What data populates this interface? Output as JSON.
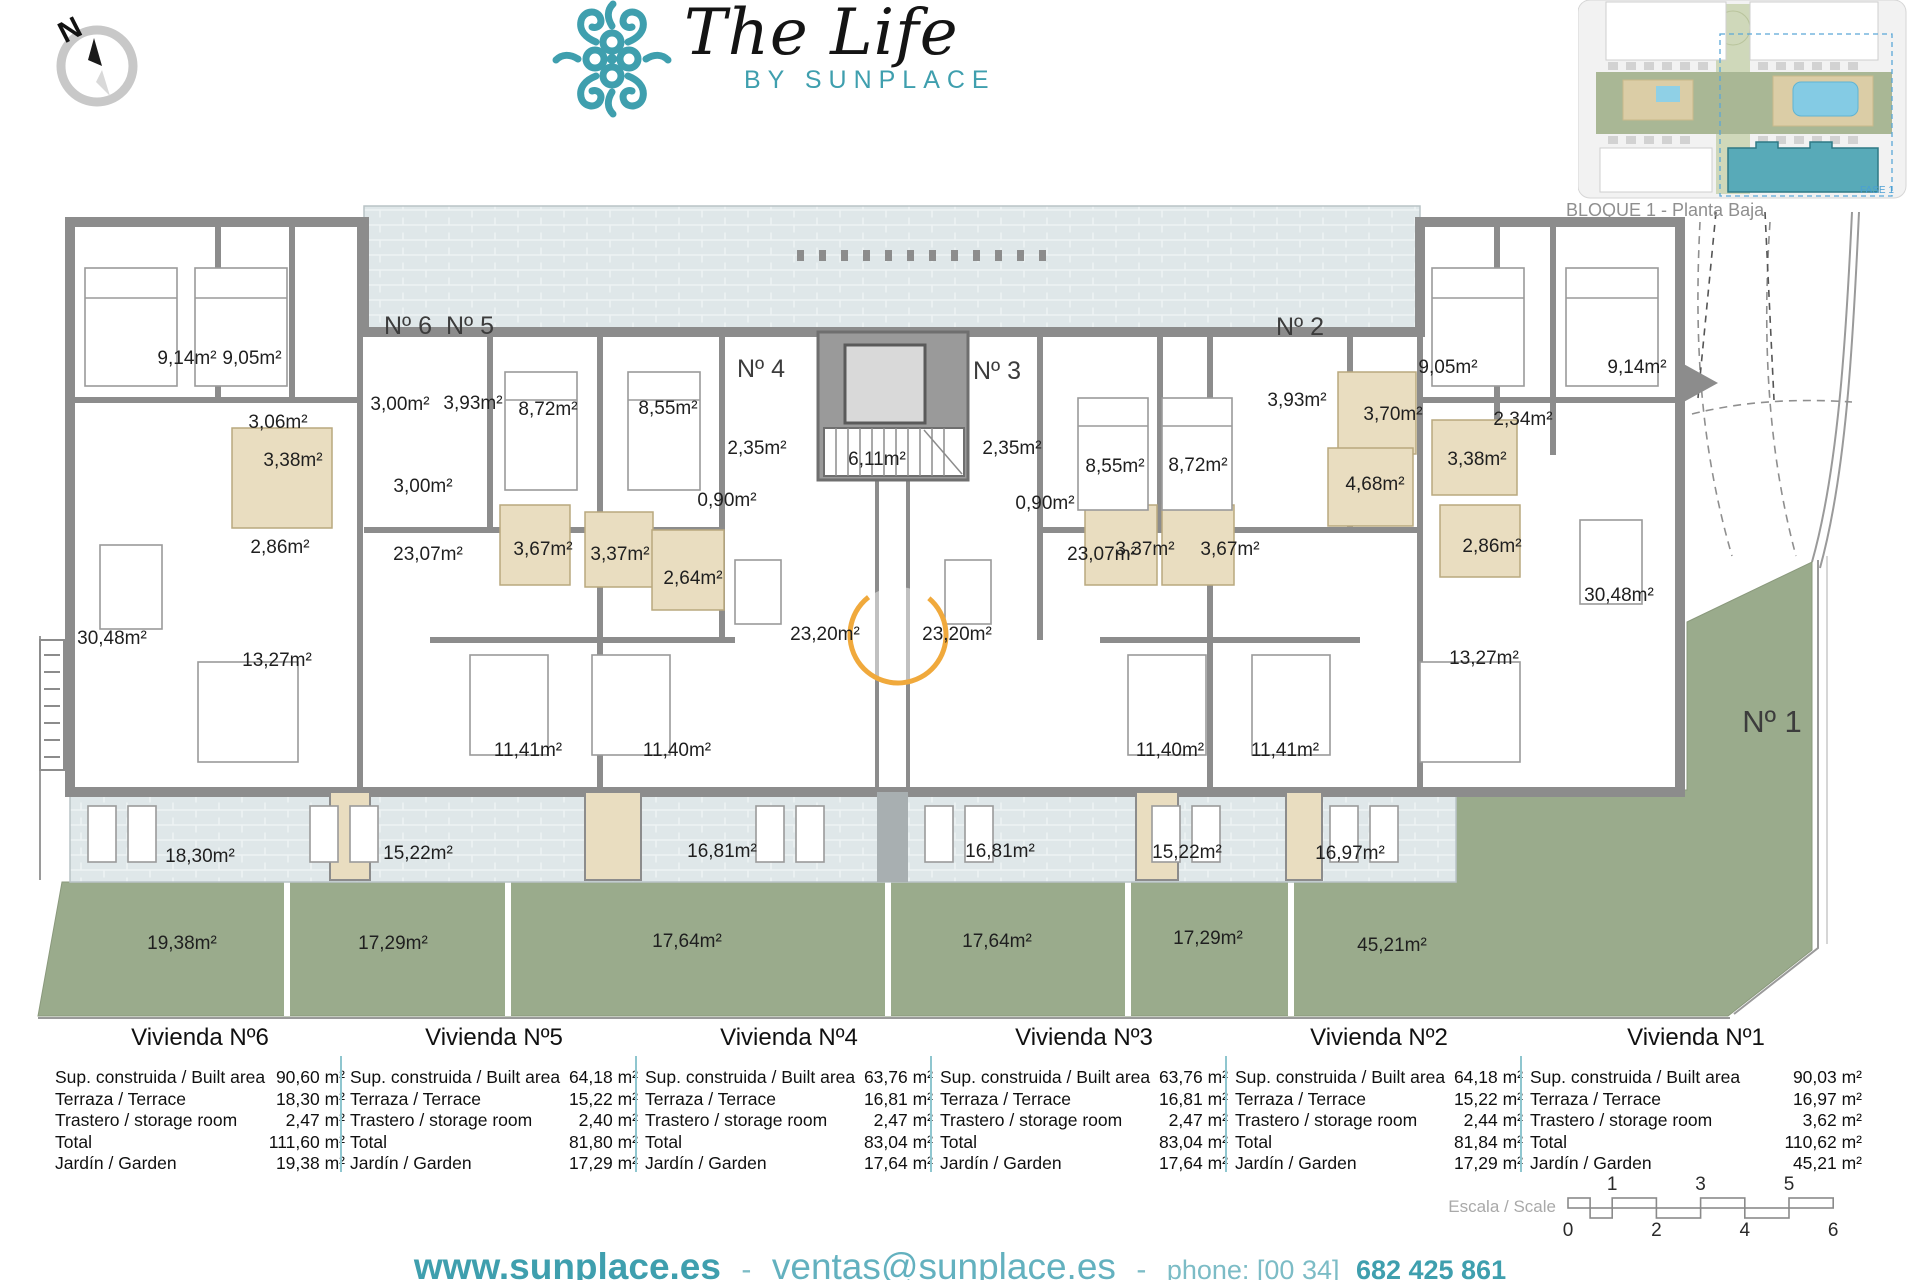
{
  "brand": {
    "title": "The Life",
    "subtitle": "BY SUNPLACE",
    "accent_color": "#3f9fae"
  },
  "compass": {
    "label": "N"
  },
  "site_inset": {
    "caption": "BLOQUE 1 - Planta Baja",
    "fase_label": "FASE 1",
    "highlight_color": "#58aab8",
    "pool_color": "#84cbe4",
    "green_color": "#a9b795"
  },
  "plan": {
    "wall_color": "#8c8c8c",
    "terrace_color": "#dfe7e9",
    "garden_color": "#9aab8c",
    "bath_color": "#e9ddc0",
    "watermark_color": "#f0a93c",
    "unit_labels": [
      {
        "t": "Nº 6",
        "x": 408,
        "y": 334
      },
      {
        "t": "Nº 5",
        "x": 470,
        "y": 334
      },
      {
        "t": "Nº 4",
        "x": 761,
        "y": 377
      },
      {
        "t": "Nº 3",
        "x": 997,
        "y": 379
      },
      {
        "t": "Nº 2",
        "x": 1300,
        "y": 335
      },
      {
        "t": "Nº 1",
        "x": 1772,
        "y": 732,
        "big": true
      }
    ],
    "area_labels": [
      {
        "t": "9,14m²",
        "x": 187,
        "y": 364
      },
      {
        "t": "9,05m²",
        "x": 252,
        "y": 364
      },
      {
        "t": "3,06m²",
        "x": 278,
        "y": 428
      },
      {
        "t": "3,38m²",
        "x": 293,
        "y": 466
      },
      {
        "t": "3,00m²",
        "x": 400,
        "y": 410
      },
      {
        "t": "3,93m²",
        "x": 473,
        "y": 409
      },
      {
        "t": "3,00m²",
        "x": 423,
        "y": 492
      },
      {
        "t": "2,86m²",
        "x": 280,
        "y": 553
      },
      {
        "t": "30,48m²",
        "x": 112,
        "y": 644
      },
      {
        "t": "23,07m²",
        "x": 428,
        "y": 560
      },
      {
        "t": "13,27m²",
        "x": 277,
        "y": 666
      },
      {
        "t": "8,72m²",
        "x": 548,
        "y": 415
      },
      {
        "t": "8,55m²",
        "x": 668,
        "y": 414
      },
      {
        "t": "3,67m²",
        "x": 543,
        "y": 555
      },
      {
        "t": "3,37m²",
        "x": 620,
        "y": 560
      },
      {
        "t": "2,64m²",
        "x": 693,
        "y": 584
      },
      {
        "t": "2,35m²",
        "x": 757,
        "y": 454
      },
      {
        "t": "0,90m²",
        "x": 727,
        "y": 506
      },
      {
        "t": "6,11m²",
        "x": 877,
        "y": 465
      },
      {
        "t": "11,41m²",
        "x": 528,
        "y": 756
      },
      {
        "t": "11,40m²",
        "x": 677,
        "y": 756
      },
      {
        "t": "23,20m²",
        "x": 825,
        "y": 640
      },
      {
        "t": "23,20m²",
        "x": 957,
        "y": 640
      },
      {
        "t": "2,35m²",
        "x": 1012,
        "y": 454
      },
      {
        "t": "0,90m²",
        "x": 1045,
        "y": 509
      },
      {
        "t": "8,55m²",
        "x": 1115,
        "y": 472
      },
      {
        "t": "8,72m²",
        "x": 1198,
        "y": 471
      },
      {
        "t": "3,37m²",
        "x": 1145,
        "y": 555
      },
      {
        "t": "3,67m²",
        "x": 1230,
        "y": 555
      },
      {
        "t": "3,93m²",
        "x": 1297,
        "y": 406
      },
      {
        "t": "3,70m²",
        "x": 1393,
        "y": 420
      },
      {
        "t": "4,68m²",
        "x": 1375,
        "y": 490
      },
      {
        "t": "9,05m²",
        "x": 1448,
        "y": 373
      },
      {
        "t": "2,34m²",
        "x": 1523,
        "y": 425
      },
      {
        "t": "9,14m²",
        "x": 1637,
        "y": 373
      },
      {
        "t": "3,38m²",
        "x": 1477,
        "y": 465
      },
      {
        "t": "2,86m²",
        "x": 1492,
        "y": 552
      },
      {
        "t": "23,07m²",
        "x": 1102,
        "y": 560
      },
      {
        "t": "13,27m²",
        "x": 1484,
        "y": 664
      },
      {
        "t": "30,48m²",
        "x": 1619,
        "y": 601
      },
      {
        "t": "11,40m²",
        "x": 1170,
        "y": 756
      },
      {
        "t": "11,41m²",
        "x": 1285,
        "y": 756
      },
      {
        "t": "18,30m²",
        "x": 200,
        "y": 862
      },
      {
        "t": "15,22m²",
        "x": 418,
        "y": 859
      },
      {
        "t": "16,81m²",
        "x": 722,
        "y": 857
      },
      {
        "t": "16,81m²",
        "x": 1000,
        "y": 857
      },
      {
        "t": "15,22m²",
        "x": 1187,
        "y": 858
      },
      {
        "t": "16,97m²",
        "x": 1350,
        "y": 859
      },
      {
        "t": "19,38m²",
        "x": 182,
        "y": 949
      },
      {
        "t": "17,29m²",
        "x": 393,
        "y": 949
      },
      {
        "t": "17,64m²",
        "x": 687,
        "y": 947
      },
      {
        "t": "17,64m²",
        "x": 997,
        "y": 947
      },
      {
        "t": "17,29m²",
        "x": 1208,
        "y": 944
      },
      {
        "t": "45,21m²",
        "x": 1392,
        "y": 951
      }
    ]
  },
  "summary_tables": {
    "divider_color": "#8fc6cf",
    "row_labels": [
      "Sup. construida / Built area",
      "Terraza / Terrace",
      "Trastero / storage room",
      "Total",
      "Jardín / Garden"
    ],
    "units": [
      {
        "name": "Vivienda Nº6",
        "values": [
          "90,60 m²",
          "18,30 m²",
          "2,47 m²",
          "111,60 m²",
          "19,38 m²"
        ]
      },
      {
        "name": "Vivienda Nº5",
        "values": [
          "64,18 m²",
          "15,22 m²",
          "2,40 m²",
          "81,80 m²",
          "17,29 m²"
        ]
      },
      {
        "name": "Vivienda Nº4",
        "values": [
          "63,76 m²",
          "16,81 m²",
          "2,47 m²",
          "83,04 m²",
          "17,64 m²"
        ]
      },
      {
        "name": "Vivienda Nº3",
        "values": [
          "63,76 m²",
          "16,81 m²",
          "2,47 m²",
          "83,04 m²",
          "17,64 m²"
        ]
      },
      {
        "name": "Vivienda Nº2",
        "values": [
          "64,18 m²",
          "15,22 m²",
          "2,44 m²",
          "81,84 m²",
          "17,29 m²"
        ]
      },
      {
        "name": "Vivienda Nº1",
        "values": [
          "90,03 m²",
          "16,97 m²",
          "3,62 m²",
          "110,62 m²",
          "45,21 m²"
        ]
      }
    ]
  },
  "scale_bar": {
    "label": "Escala / Scale",
    "top_ticks": [
      "1",
      "3",
      "5"
    ],
    "bottom_ticks": [
      "0",
      "2",
      "4",
      "6"
    ]
  },
  "footer": {
    "website": "www.sunplace.es",
    "sep": "-",
    "email": "ventas@sunplace.es",
    "phone_prefix": "phone: [00 34]",
    "phone": "682 425 861"
  }
}
